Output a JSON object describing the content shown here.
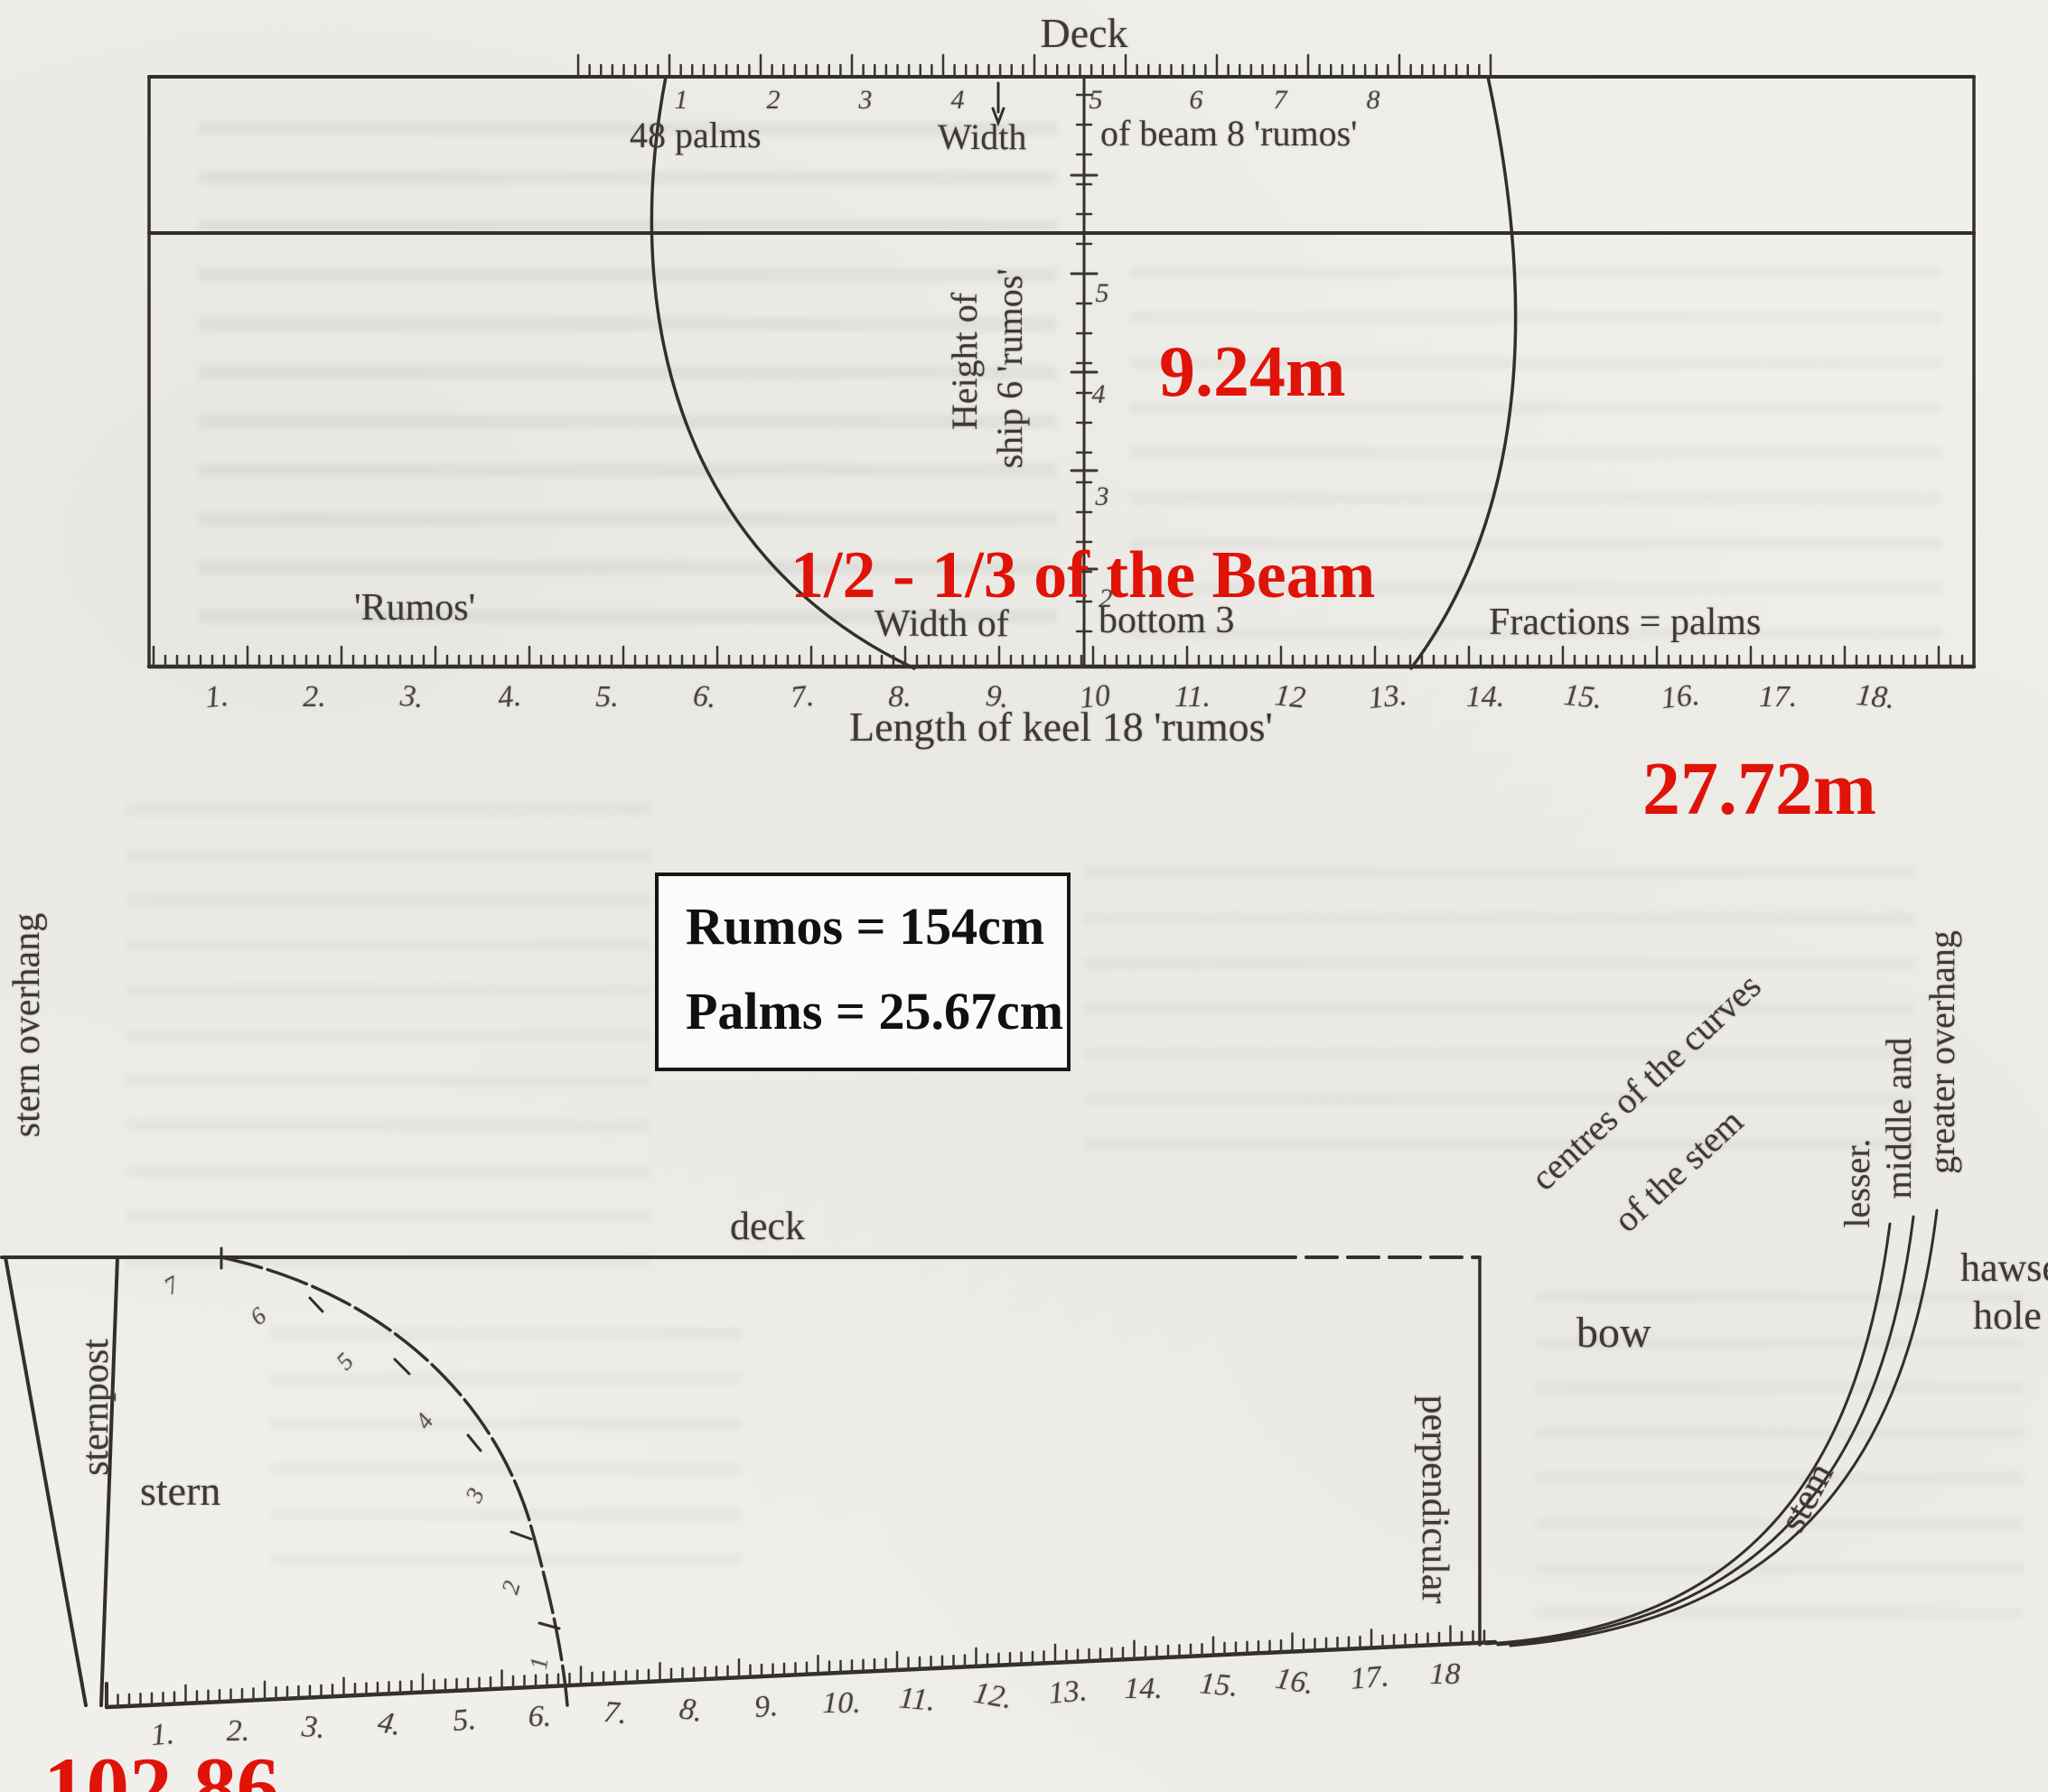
{
  "annotations": {
    "accent_color": "#e01309",
    "height_m": "9.24m",
    "beam_note": "1/2 - 1/3 of the Beam",
    "keel_m": "27.72m",
    "keel_palms": "102.86"
  },
  "legend_box": {
    "line1": "Rumos = 154cm",
    "line2": "Palms = 25.67cm"
  },
  "top_diagram": {
    "deck_label": "Deck",
    "palms_label": "48 palms",
    "width_label": "Width",
    "beam_label": "of beam 8 'rumos'",
    "height_label_line1": "Height of",
    "height_label_line2": "ship 6 'rumos'",
    "rumos_label": "'Rumos'",
    "width_of_label": "Width of",
    "bottom_label": "bottom 3",
    "fractions_label": "Fractions = palms",
    "keel_label": "Length of keel 18 'rumos'",
    "beam_ticks": [
      "1",
      "2",
      "3",
      "4",
      "5",
      "6",
      "7",
      "8"
    ],
    "height_ticks": [
      "5",
      "4",
      "3",
      "2"
    ],
    "keel_ticks": [
      "1.",
      "2.",
      "3.",
      "4.",
      "5.",
      "6.",
      "7.",
      "8.",
      "9.",
      "10",
      "11.",
      "12",
      "13.",
      "14.",
      "15.",
      "16.",
      "17.",
      "18."
    ]
  },
  "bottom_diagram": {
    "deck_label": "deck",
    "stern_overhang_label": "stern overhang",
    "sternpost_label": "sternpost",
    "stern_label": "stern",
    "perpendicular_label": "perpendicular",
    "bow_label": "bow",
    "stem_label": "stem",
    "centres_label_line1": "centres of the curves",
    "centres_label_line2": "of the stem",
    "overhang_labels": [
      "lesser.",
      "middle and",
      "greater overhang"
    ],
    "hawse_line1": "hawse",
    "hawse_line2": "hole",
    "curve_ticks": [
      "7",
      "6",
      "5",
      "4",
      "3",
      "2",
      "1"
    ],
    "keel_ticks": [
      "1.",
      "2.",
      "3.",
      "4.",
      "5.",
      "6.",
      "7.",
      "8.",
      "9.",
      "10.",
      "11.",
      "12.",
      "13.",
      "14.",
      "15.",
      "16.",
      "17.",
      "18"
    ]
  }
}
